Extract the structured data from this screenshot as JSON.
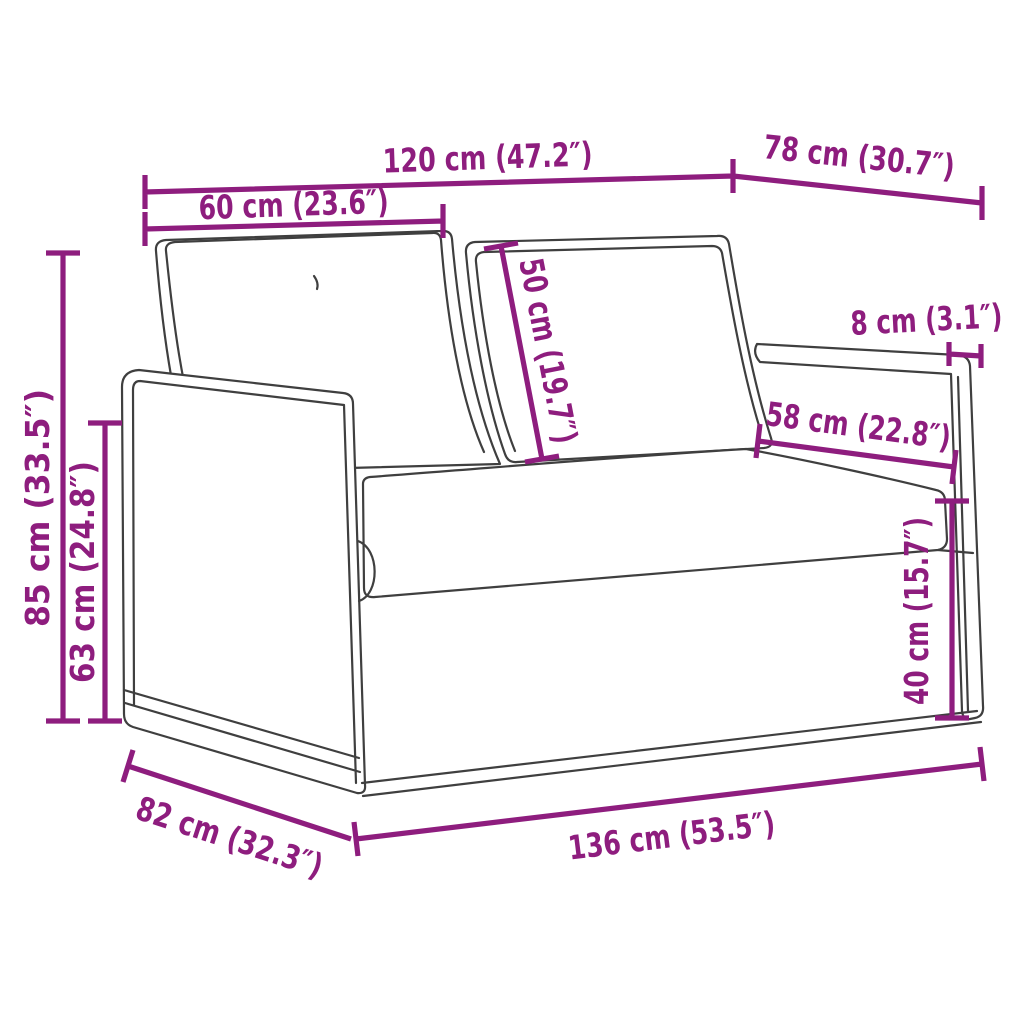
{
  "figure": {
    "type": "product-dimension-diagram",
    "subject": "two-seater loveseat sofa line drawing with cushions",
    "colors": {
      "background": "#ffffff",
      "dimension_accent": "#8e1d7e",
      "sofa_outline": "#3f3f3f"
    },
    "dimensions": [
      {
        "name": "back-width",
        "label": "120 cm (47.2″)",
        "cm": 120,
        "inches": 47.2
      },
      {
        "name": "top-depth",
        "label": "78 cm (30.7″)",
        "cm": 78,
        "inches": 30.7
      },
      {
        "name": "back-cushion-width",
        "label": "60 cm (23.6″)",
        "cm": 60,
        "inches": 23.6
      },
      {
        "name": "back-cushion-height",
        "label": "50 cm (19.7″)",
        "cm": 50,
        "inches": 19.7
      },
      {
        "name": "armrest-width",
        "label": "8 cm (3.1″)",
        "cm": 8,
        "inches": 3.1
      },
      {
        "name": "seat-cushion-width",
        "label": "58 cm (22.8″)",
        "cm": 58,
        "inches": 22.8
      },
      {
        "name": "seat-height",
        "label": "40 cm (15.7″)",
        "cm": 40,
        "inches": 15.7
      },
      {
        "name": "overall-height",
        "label": "85 cm (33.5″)",
        "cm": 85,
        "inches": 33.5
      },
      {
        "name": "armrest-height",
        "label": "63 cm (24.8″)",
        "cm": 63,
        "inches": 24.8
      },
      {
        "name": "overall-width",
        "label": "136 cm (53.5″)",
        "cm": 136,
        "inches": 53.5
      },
      {
        "name": "overall-depth",
        "label": "82 cm (32.3″)",
        "cm": 82,
        "inches": 32.3
      }
    ]
  }
}
